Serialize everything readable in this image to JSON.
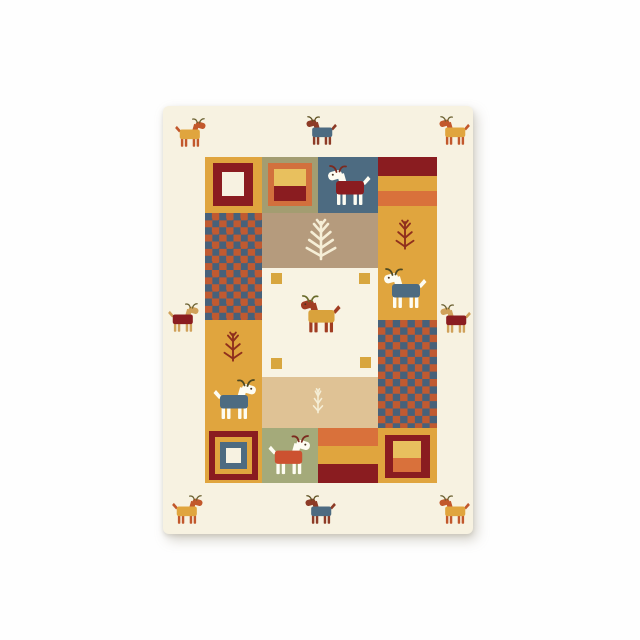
{
  "scene": {
    "width": 640,
    "height": 640,
    "background": "#fefefe"
  },
  "palette": {
    "rug_cream": "#f7f2e1",
    "center_cream": "#f8f3e3",
    "mustard": "#e0a53e",
    "maroon": "#8a1c20",
    "burnt_orange": "#d9713b",
    "slate_blue": "#4d6b81",
    "olive": "#a39d71",
    "sage": "#a4aa7a",
    "taupe": "#b59b7d",
    "light_tan": "#dfc295",
    "amber": "#e8c05e",
    "checker_red": "#c05a31",
    "checker_blue": "#47617a",
    "square_amber": "#d8a63f",
    "goat_white": "#fdfcf2",
    "tree_red": "#8f2f1d",
    "tree_cream": "#f5eed6"
  },
  "rug": {
    "x": 163,
    "y": 106,
    "w": 310,
    "h": 428,
    "background": "#f7f2e1",
    "blocks": [
      {
        "name": "top-left-framed-square-block",
        "x": 42,
        "y": 51,
        "w": 57,
        "h": 56,
        "bg": "#e0a53e",
        "layers": [
          {
            "name": "maroon-frame",
            "x": 8,
            "y": 6,
            "w": 40,
            "h": 43,
            "color": "#8a1c20"
          },
          {
            "name": "cream-center",
            "x": 17,
            "y": 15,
            "w": 22,
            "h": 24,
            "color": "#f7f2e1"
          }
        ]
      },
      {
        "name": "top-olive-split-square-block",
        "x": 99,
        "y": 51,
        "w": 56,
        "h": 56,
        "bg": "#a39d71",
        "layers": [
          {
            "name": "orange-frame",
            "x": 6,
            "y": 6,
            "w": 44,
            "h": 43,
            "color": "#d2703d"
          },
          {
            "name": "amber-half",
            "x": 12,
            "y": 12,
            "w": 32,
            "h": 17,
            "color": "#e8c05e"
          },
          {
            "name": "maroon-half",
            "x": 12,
            "y": 29,
            "w": 32,
            "h": 15,
            "color": "#8a1c20"
          }
        ]
      },
      {
        "name": "top-blue-goat-block",
        "x": 155,
        "y": 51,
        "w": 60,
        "h": 56,
        "bg": "#4d6b81",
        "layers": []
      },
      {
        "name": "right-maroon-band",
        "x": 215,
        "y": 51,
        "w": 59,
        "h": 19,
        "bg": "#8a1c20",
        "layers": []
      },
      {
        "name": "right-amber-band",
        "x": 215,
        "y": 70,
        "w": 59,
        "h": 15,
        "bg": "#e0a53e",
        "layers": []
      },
      {
        "name": "right-orange-band",
        "x": 215,
        "y": 85,
        "w": 59,
        "h": 15,
        "bg": "#d9713b",
        "layers": []
      },
      {
        "name": "right-mustard-block",
        "x": 215,
        "y": 100,
        "w": 59,
        "h": 114,
        "bg": "#e0a53e",
        "layers": []
      },
      {
        "name": "right-checkerboard-block",
        "x": 215,
        "y": 214,
        "w": 59,
        "h": 108,
        "checker": {
          "c1": "#c05a31",
          "c2": "#47617a",
          "cell": 7.375
        },
        "layers": []
      },
      {
        "name": "bottom-right-framed-square-block",
        "x": 215,
        "y": 322,
        "w": 59,
        "h": 55,
        "bg": "#e0a53e",
        "layers": [
          {
            "name": "maroon-frame",
            "x": 7,
            "y": 7,
            "w": 45,
            "h": 43,
            "color": "#8a1c20"
          },
          {
            "name": "amber-half",
            "x": 15,
            "y": 13,
            "w": 28,
            "h": 17,
            "color": "#e8c05e"
          },
          {
            "name": "orange-half",
            "x": 15,
            "y": 30,
            "w": 28,
            "h": 14,
            "color": "#d9713b"
          }
        ]
      },
      {
        "name": "left-checkerboard-block",
        "x": 42,
        "y": 107,
        "w": 57,
        "h": 107,
        "checker": {
          "c1": "#c05a31",
          "c2": "#47617a",
          "cell": 7.125
        },
        "layers": []
      },
      {
        "name": "left-mustard-block",
        "x": 42,
        "y": 214,
        "w": 57,
        "h": 108,
        "bg": "#e0a53e",
        "layers": []
      },
      {
        "name": "bottom-left-nested-square-block",
        "x": 42,
        "y": 322,
        "w": 57,
        "h": 55,
        "bg": "#e0a53e",
        "layers": [
          {
            "name": "maroon-frame",
            "x": 4,
            "y": 3,
            "w": 49,
            "h": 49,
            "color": "#8a1c20"
          },
          {
            "name": "amber-frame",
            "x": 10,
            "y": 9,
            "w": 37,
            "h": 37,
            "color": "#e0a53e"
          },
          {
            "name": "blue-frame",
            "x": 15,
            "y": 14,
            "w": 27,
            "h": 27,
            "color": "#4d6b81"
          },
          {
            "name": "white-center",
            "x": 21,
            "y": 20,
            "w": 15,
            "h": 15,
            "color": "#f7f2e1"
          }
        ]
      },
      {
        "name": "middle-taupe-tree-block",
        "x": 99,
        "y": 107,
        "w": 116,
        "h": 55,
        "bg": "#b59b7d",
        "layers": []
      },
      {
        "name": "center-cream-block",
        "x": 99,
        "y": 162,
        "w": 116,
        "h": 109,
        "bg": "#f8f3e3",
        "layers": [
          {
            "name": "corner-square",
            "x": 9,
            "y": 5,
            "w": 11,
            "h": 11,
            "color": "#d8a63f"
          },
          {
            "name": "corner-square",
            "x": 97,
            "y": 5,
            "w": 11,
            "h": 11,
            "color": "#d8a63f"
          },
          {
            "name": "corner-square",
            "x": 9,
            "y": 90,
            "w": 11,
            "h": 11,
            "color": "#d8a63f"
          },
          {
            "name": "corner-square",
            "x": 98,
            "y": 89,
            "w": 11,
            "h": 11,
            "color": "#d8a63f"
          }
        ]
      },
      {
        "name": "middle-tan-sprig-block",
        "x": 99,
        "y": 271,
        "w": 116,
        "h": 51,
        "bg": "#dfc295",
        "layers": []
      },
      {
        "name": "bottom-sage-goat-block",
        "x": 99,
        "y": 322,
        "w": 56,
        "h": 55,
        "bg": "#a4aa7a",
        "layers": []
      },
      {
        "name": "bottom-stripes-block",
        "x": 155,
        "y": 322,
        "w": 60,
        "h": 55,
        "bg": "#d9713b",
        "layers": [
          {
            "name": "amber-stripe",
            "x": 0,
            "y": 18,
            "w": 60,
            "h": 18,
            "color": "#e0a53e"
          },
          {
            "name": "maroon-stripe",
            "x": 0,
            "y": 36,
            "w": 60,
            "h": 19,
            "color": "#8a1c20"
          }
        ]
      }
    ],
    "trees": [
      {
        "name": "taupe-block-pine-tree",
        "cx": 158,
        "cy": 134,
        "w": 36,
        "h": 44,
        "color": "#f5eed6",
        "pairs": 4,
        "spread": 1.0
      },
      {
        "name": "right-column-pine-tree",
        "cx": 242,
        "cy": 129,
        "w": 26,
        "h": 36,
        "color": "#8f2f1d",
        "pairs": 3,
        "spread": 1.0
      },
      {
        "name": "left-column-pine-tree",
        "cx": 70,
        "cy": 241,
        "w": 26,
        "h": 36,
        "color": "#8f2f1d",
        "pairs": 3,
        "spread": 1.0
      },
      {
        "name": "tan-block-sprig",
        "cx": 155,
        "cy": 295,
        "w": 22,
        "h": 32,
        "color": "#f5eed6",
        "pairs": 3,
        "spread": 0.62
      }
    ],
    "goats": [
      {
        "name": "border-goat-top-left",
        "cx": 27,
        "cy": 27,
        "w": 33,
        "facing": "right",
        "coat": "#e0a53e",
        "skin": "#c2582c",
        "horn": "#6a6030",
        "eye": false
      },
      {
        "name": "border-goat-top-center",
        "cx": 158,
        "cy": 25,
        "w": 33,
        "facing": "left",
        "coat": "#4d6b81",
        "skin": "#8d3b26",
        "horn": "#5c4f20",
        "eye": false
      },
      {
        "name": "border-goat-top-right",
        "cx": 291,
        "cy": 25,
        "w": 33,
        "facing": "left",
        "coat": "#e0a53e",
        "skin": "#c2582c",
        "horn": "#6a6030",
        "eye": false
      },
      {
        "name": "border-goat-middle-left",
        "cx": 20,
        "cy": 212,
        "w": 33,
        "facing": "right",
        "coat": "#8a1c20",
        "skin": "#d0a15a",
        "horn": "#6a6030",
        "eye": false
      },
      {
        "name": "border-goat-middle-right",
        "cx": 292,
        "cy": 213,
        "w": 33,
        "facing": "left",
        "coat": "#8a1c20",
        "skin": "#d0a15a",
        "horn": "#6a6030",
        "eye": false
      },
      {
        "name": "border-goat-bottom-left",
        "cx": 24,
        "cy": 404,
        "w": 33,
        "facing": "right",
        "coat": "#e0a53e",
        "skin": "#c2582c",
        "horn": "#6a6030",
        "eye": false
      },
      {
        "name": "border-goat-bottom-center",
        "cx": 157,
        "cy": 404,
        "w": 33,
        "facing": "left",
        "coat": "#4d6b81",
        "skin": "#8d3b26",
        "horn": "#5c4f20",
        "eye": false
      },
      {
        "name": "border-goat-bottom-right",
        "cx": 291,
        "cy": 404,
        "w": 33,
        "facing": "left",
        "coat": "#e0a53e",
        "skin": "#c2582c",
        "horn": "#6a6030",
        "eye": false
      },
      {
        "name": "blue-block-goat",
        "cx": 186,
        "cy": 80,
        "w": 46,
        "facing": "left",
        "coat": "#8a1c20",
        "skin": "#fdfcf2",
        "horn": "#7c2a1f",
        "eye": true
      },
      {
        "name": "right-column-goat",
        "cx": 242,
        "cy": 183,
        "w": 46,
        "facing": "left",
        "coat": "#4d6b81",
        "skin": "#fdfcf2",
        "horn": "#4f4a22",
        "eye": true
      },
      {
        "name": "left-column-goat",
        "cx": 72,
        "cy": 294,
        "w": 46,
        "facing": "right",
        "coat": "#4d6b81",
        "skin": "#fdfcf2",
        "horn": "#4f4a22",
        "eye": true
      },
      {
        "name": "center-goat",
        "cx": 157,
        "cy": 209,
        "w": 43,
        "facing": "left",
        "coat": "#d9a23c",
        "skin": "#a03c22",
        "horn": "#6a6b2b",
        "eye": true
      },
      {
        "name": "sage-block-goat",
        "cx": 126,
        "cy": 350,
        "w": 45,
        "facing": "right",
        "coat": "#cc5130",
        "skin": "#fdfcf2",
        "horn": "#7c2a1f",
        "eye": true
      }
    ]
  }
}
